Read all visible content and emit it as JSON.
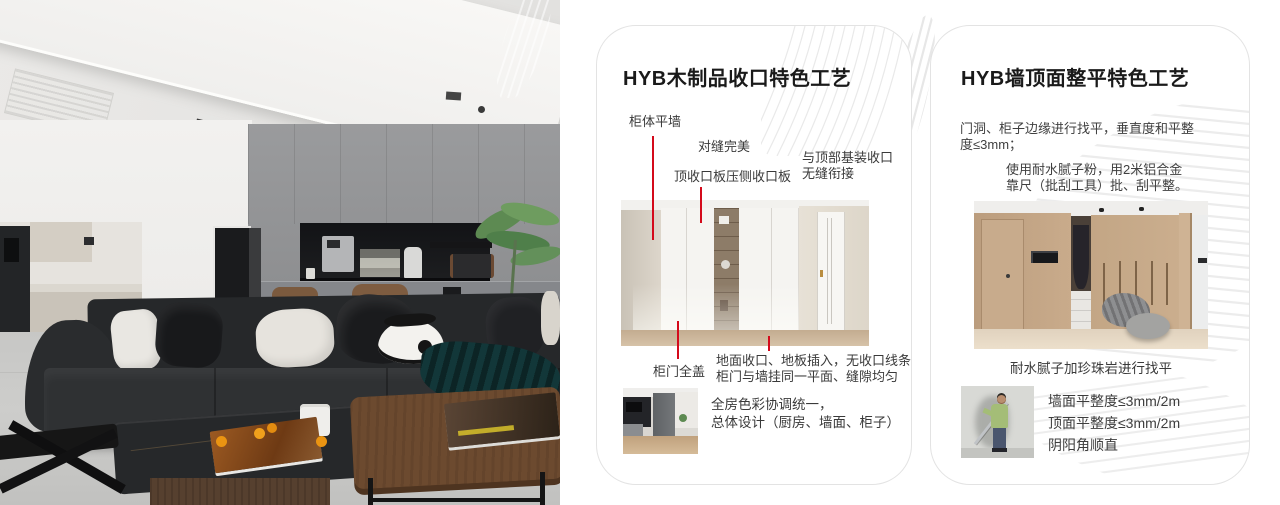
{
  "theme": {
    "accent_red": "#d40a1b",
    "card_border": "#e3e3e3",
    "title_color": "#1a1a1a",
    "body_text_color": "#3f3f3f",
    "background": "#ffffff"
  },
  "cards": [
    {
      "title": "HYB木制品收口特色工艺",
      "annotations": {
        "cabinet_flush": "柜体平墙",
        "seam_perfect": "对缝完美",
        "top_board": "顶收口板压侧收口板",
        "top_joint": [
          "与顶部基装收口",
          "无缝衔接"
        ],
        "door_full_cover": "柜门全盖",
        "floor_joint": [
          "地面收口、地板插入，无收口线条",
          "柜门与墙挂同一平面、缝隙均匀"
        ],
        "color_unify": [
          "全房色彩协调统一，",
          "总体设计（厨房、墙面、柜子）"
        ]
      }
    },
    {
      "title": "HYB墙顶面整平特色工艺",
      "paragraph1": [
        "门洞、柜子边缘进行找平，垂直度和平整",
        "度≤3mm；"
      ],
      "paragraph2": [
        "使用耐水腻子粉，用2米铝合金",
        "靠尺（批刮工具）批、刮平整。"
      ],
      "photo_caption": "耐水腻子加珍珠岩进行找平",
      "specs": [
        "墙面平整度≤3mm/2m",
        "顶面平整度≤3mm/2m",
        "阴阳角顺直"
      ]
    }
  ]
}
